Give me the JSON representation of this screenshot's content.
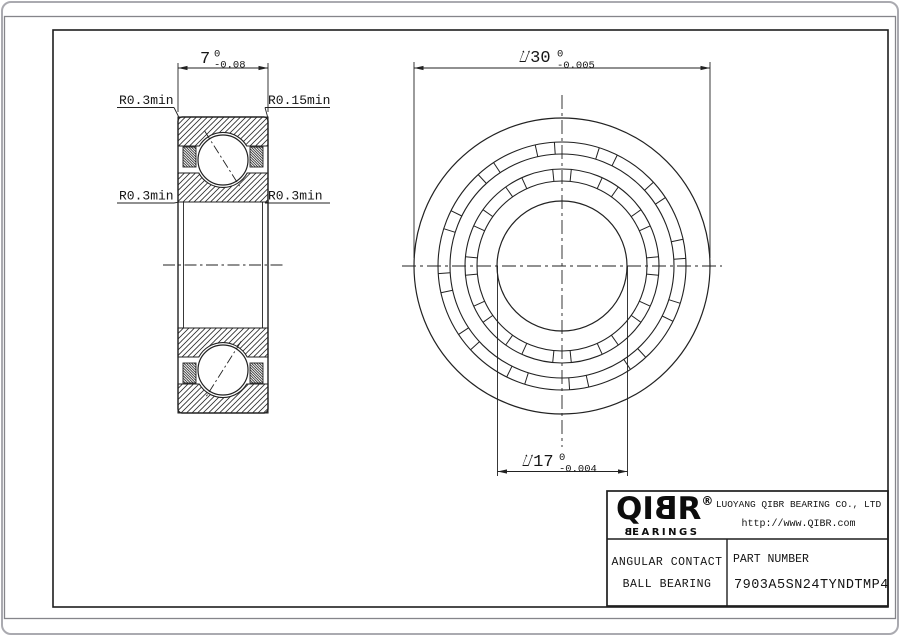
{
  "left_view": {
    "width_dim": {
      "value": "7",
      "tol_upper": "0",
      "tol_lower": "-0.08"
    },
    "radius_labels": {
      "top_left": "R0.3min",
      "top_right": "R0.15min",
      "mid_left": "R0.3min",
      "mid_right": "R0.3min"
    }
  },
  "front_view": {
    "od_dim": {
      "text": "⌰30",
      "tol_upper": "0",
      "tol_lower": "-0.005"
    },
    "bore_dim": {
      "text": "⌰17",
      "tol_upper": "0",
      "tol_lower": "-0.004"
    }
  },
  "title_block": {
    "logo_left": "QI",
    "logo_b": "B",
    "logo_right": "R",
    "logo_registered": "®",
    "logo_sub_b": "B",
    "logo_sub_rest": "EARINGS",
    "company": "LUOYANG QIBR BEARING CO., LTD",
    "website": "http://www.QIBR.com",
    "product_line1": "ANGULAR CONTACT",
    "product_line2": "BALL BEARING",
    "part_number_label": "PART NUMBER",
    "part_number": "7903A5SN24TYNDTMP4"
  },
  "colors": {
    "line": "#222222",
    "sheet_border": "#85858a",
    "window_border": "#aaaab0",
    "background": "#ffffff"
  }
}
